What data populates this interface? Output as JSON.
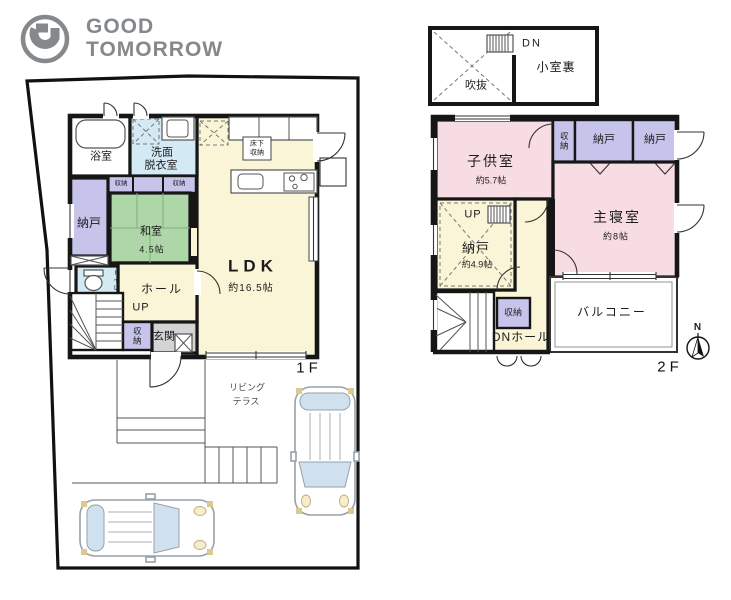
{
  "logo": {
    "line1": "GOOD",
    "line2": "TOMORROW"
  },
  "colors": {
    "wall": "#161616",
    "room_yellow": "#faf5d7",
    "room_pink": "#f8dce3",
    "room_purple": "#c7c4ec",
    "room_blue": "#d3e9f4",
    "room_green": "#afd6a9",
    "entrance_gray": "#d4d4d4",
    "logo_gray": "#85898c",
    "car_window": "#cfe0ef"
  },
  "floor1": {
    "label": "1F",
    "bath": "浴室",
    "washroom1": "洗面",
    "washroom2": "脱衣室",
    "closet": "収納",
    "storage": "納戸",
    "tatami": "和室",
    "tatami_size": "4.5帖",
    "underfloor1": "床下",
    "underfloor2": "収納",
    "ldk": "LDK",
    "ldk_size": "約16.5帖",
    "toilet": "トイレ",
    "hall": "ホール",
    "up": "UP",
    "shoe": "収納",
    "entrance": "玄関",
    "terrace1": "リビング",
    "terrace2": "テラス"
  },
  "floor2": {
    "label": "2F",
    "kids": "子供室",
    "kids_size": "約5.7帖",
    "closet": "収納",
    "storage_a": "納戸",
    "storage_b": "納戸",
    "master": "主寝室",
    "master_size": "約8帖",
    "up": "UP",
    "storage_c": "納戸",
    "storage_c_size": "約4.9帖",
    "closet2": "収納",
    "hall_label": "DNホール",
    "balcony": "バルコニー"
  },
  "attic": {
    "dn": "DN",
    "void_label": "吹抜",
    "attic_room": "小室裏"
  },
  "compass": {
    "n": "N"
  }
}
